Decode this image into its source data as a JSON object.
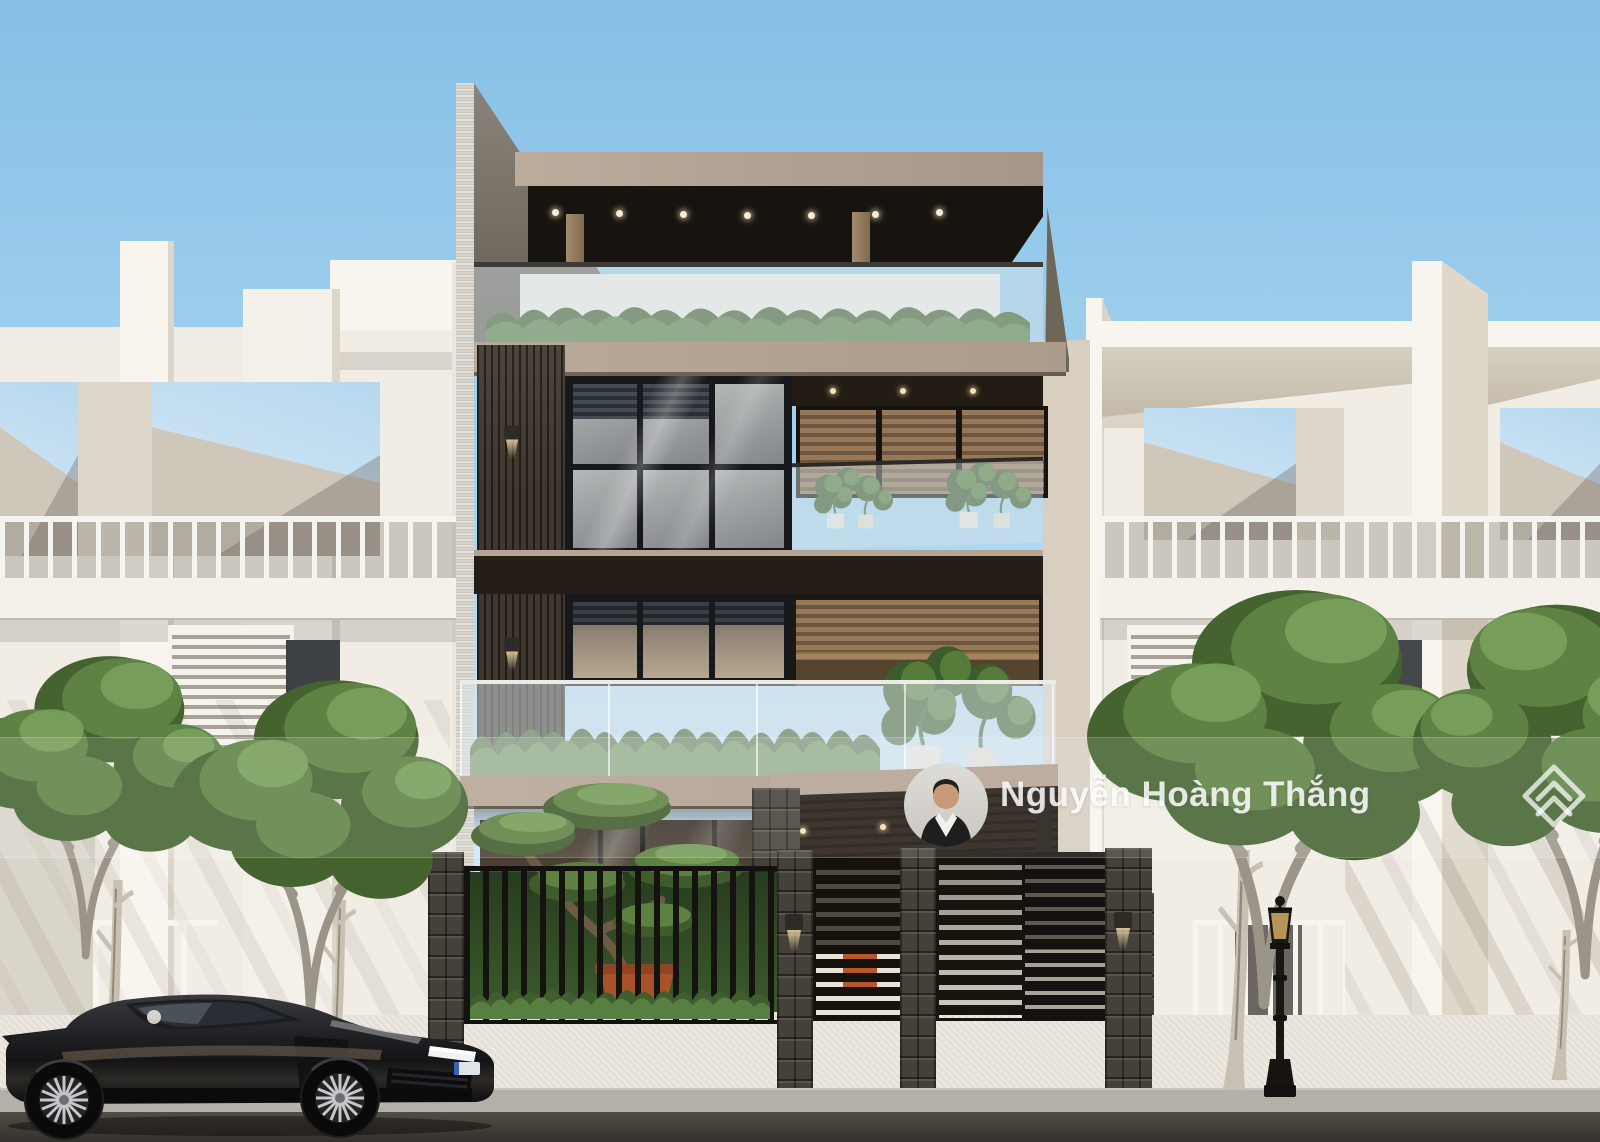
{
  "photo": {
    "kind": "3d-exterior-render-of-modern-townhouse",
    "scene_elements": [
      "sky",
      "left neighbor townhouse",
      "featured dark modern house",
      "right neighbor townhouse",
      "street trees",
      "black sports car",
      "street lamp",
      "stone fence with slatted gates"
    ]
  },
  "watermark": {
    "agent_name": "Nguyễn Hoàng Thắng",
    "avatar_icon": "agent-avatar-photo",
    "brand_icon": "brand-diamond-logo"
  },
  "palette": {
    "sky_top": "#85c0e7",
    "sky_bottom": "#ddeefa",
    "wall_white": "#f1ede5",
    "fascia_tan": "#b3a293",
    "canopy_dark": "#17130e",
    "wood_slat": "#3f372e",
    "stone_dark": "#454038",
    "plant_green": "#5d8244",
    "gate_black": "#15120e",
    "accent_orange": "#b8562b",
    "road_asphalt": "#34312c",
    "car_black": "#141416",
    "watermark_white": "rgba(255,255,255,0.85)"
  }
}
